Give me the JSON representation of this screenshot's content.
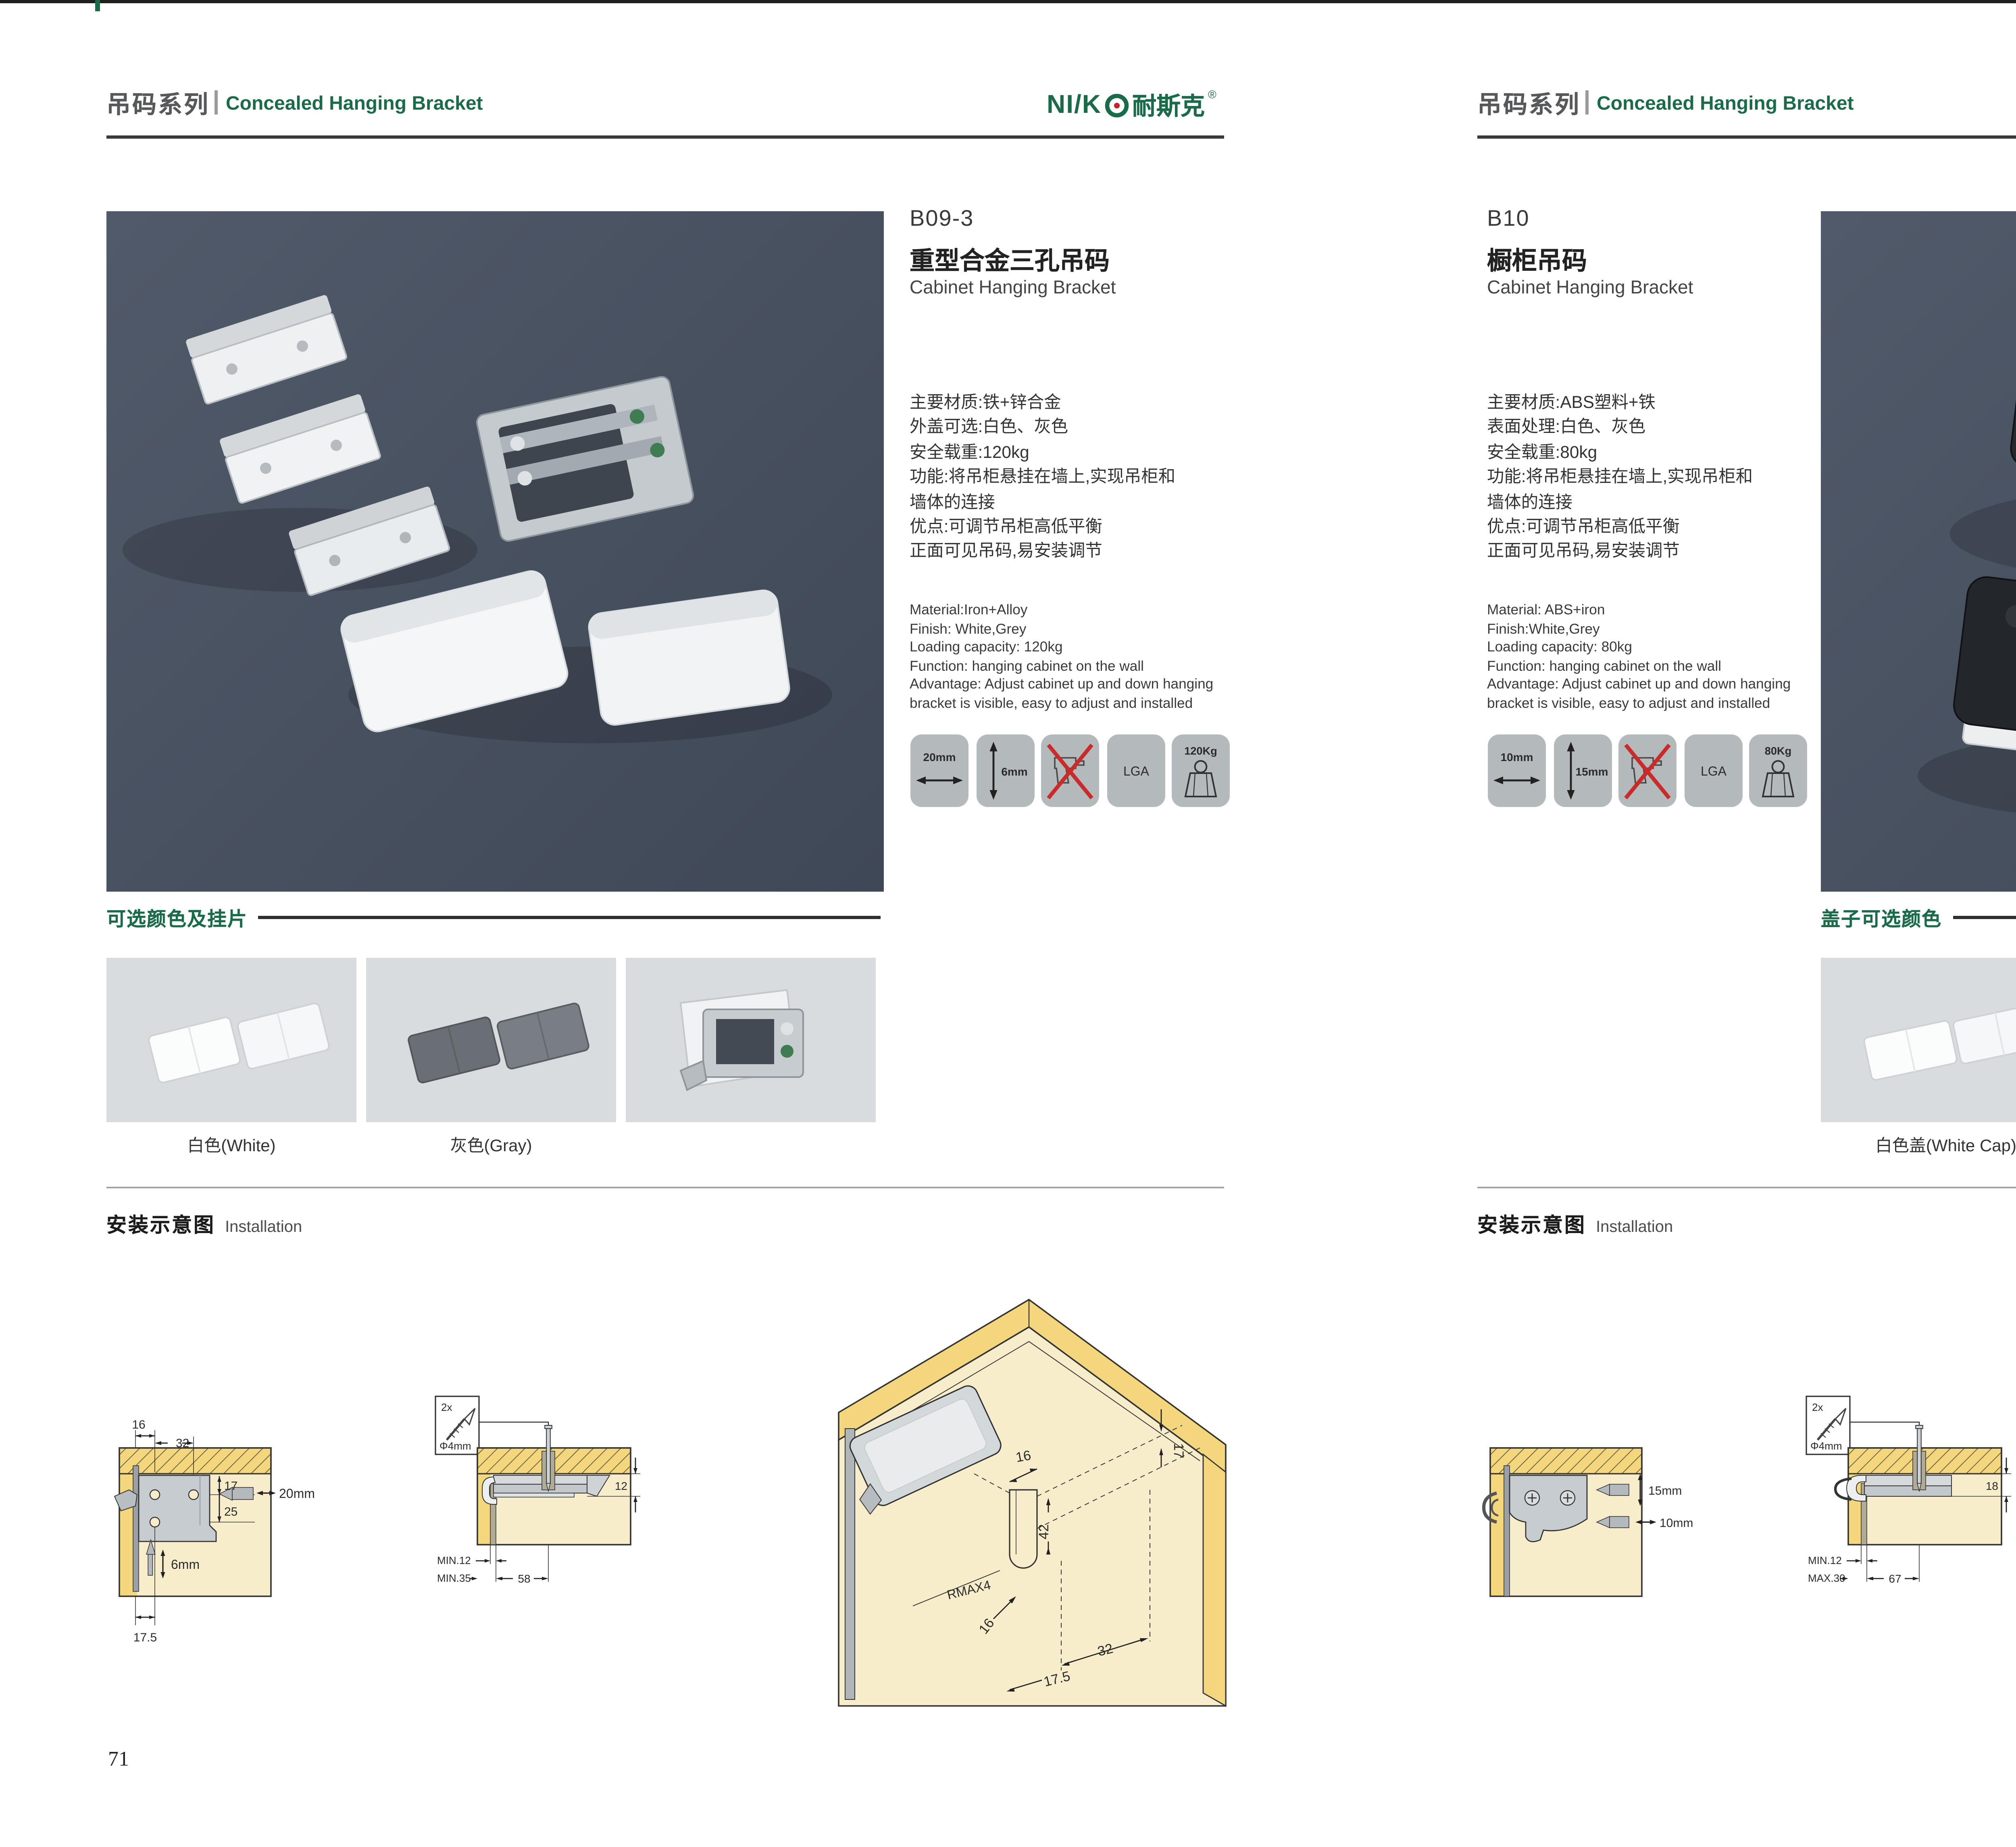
{
  "meta": {
    "colors": {
      "accent_green": "#1a6b4a",
      "header_gray": "#57585a",
      "photo_bg": "#47505f",
      "swatch_bg": "#d9dcdf",
      "icon_tile_bg": "#b4b9bc",
      "diagram_cream": "#f7edca",
      "diagram_wood": "#f4d77c",
      "red_cross": "#c92a2a",
      "logo_red_dot": "#c2262b"
    }
  },
  "brand": {
    "logo_latin": "NI/K",
    "logo_cn": "耐斯克",
    "reg": "®"
  },
  "pages": [
    {
      "page_number": "71",
      "header": {
        "series_zh": "吊码系列",
        "series_en": "Concealed Hanging Bracket"
      },
      "product": {
        "code": "B09-3",
        "name_zh": "重型合金三孔吊码",
        "name_en": "Cabinet Hanging Bracket",
        "specs_zh": [
          "主要材质:铁+锌合金",
          "外盖可选:白色、灰色",
          "安全载重:120kg",
          "功能:将吊柜悬挂在墙上,实现吊柜和",
          "墙体的连接",
          "优点:可调节吊柜高低平衡",
          "正面可见吊码,易安装调节"
        ],
        "specs_en": [
          "Material:Iron+Alloy",
          "Finish: White,Grey",
          "Loading capacity: 120kg",
          "Function: hanging cabinet on the wall",
          "Advantage: Adjust cabinet up and down hanging",
          "bracket is visible, easy to adjust and installed"
        ],
        "icons": {
          "width": "20mm",
          "thickness": "6mm",
          "lga": "LGA",
          "load": "120Kg"
        }
      },
      "colors_section": {
        "title": "可选颜色及挂片",
        "labels": [
          "白色(White)",
          "灰色(Gray)"
        ]
      },
      "installation": {
        "title_zh": "安装示意图",
        "title_en": "Installation",
        "d1": {
          "top1": "16",
          "top2": "32",
          "right1": "17",
          "right2": "25",
          "drill": "20mm",
          "screw": "6mm",
          "bottom": "17.5"
        },
        "d2": {
          "qty": "2x",
          "dia": "Φ4mm",
          "side": "12",
          "b1": "MIN.12",
          "b2": "MIN.35",
          "b3": "58"
        },
        "d3": {
          "t": "16",
          "r": "17",
          "v": "42",
          "rmax": "RMAX4",
          "b1": "16",
          "b2": "32",
          "b3": "17.5"
        }
      }
    },
    {
      "page_number": "72",
      "header": {
        "series_zh": "吊码系列",
        "series_en": "Concealed Hanging Bracket"
      },
      "product": {
        "code": "B10",
        "name_zh": "橱柜吊码",
        "name_en": "Cabinet Hanging Bracket",
        "specs_zh": [
          "主要材质:ABS塑料+铁",
          "表面处理:白色、灰色",
          "安全载重:80kg",
          "功能:将吊柜悬挂在墙上,实现吊柜和",
          "墙体的连接",
          "优点:可调节吊柜高低平衡",
          "正面可见吊码,易安装调节"
        ],
        "specs_en": [
          "Material: ABS+iron",
          "Finish:White,Grey",
          "Loading capacity: 80kg",
          "Function: hanging cabinet on the wall",
          "Advantage: Adjust cabinet up and down hanging",
          "bracket is visible, easy to adjust and installed"
        ],
        "icons": {
          "width": "10mm",
          "thickness": "15mm",
          "lga": "LGA",
          "load": "80Kg"
        }
      },
      "colors_section": {
        "title": "盖子可选颜色",
        "labels": [
          "白色盖(White Cap)",
          "灰色盖(Gray Cap)"
        ]
      },
      "installation": {
        "title_zh": "安装示意图",
        "title_en": "Installation",
        "d1": {
          "drill_v": "15mm",
          "drill_h": "10mm"
        },
        "d2": {
          "qty": "2x",
          "dia": "Φ4mm",
          "side": "18",
          "b1": "MIN.12",
          "b2": "MAX.30",
          "b3": "67"
        },
        "d3": {
          "r": "13",
          "v": "42",
          "rmax": "RMAX4",
          "b1": "19",
          "b2": "17",
          "b3": "32"
        }
      }
    }
  ]
}
